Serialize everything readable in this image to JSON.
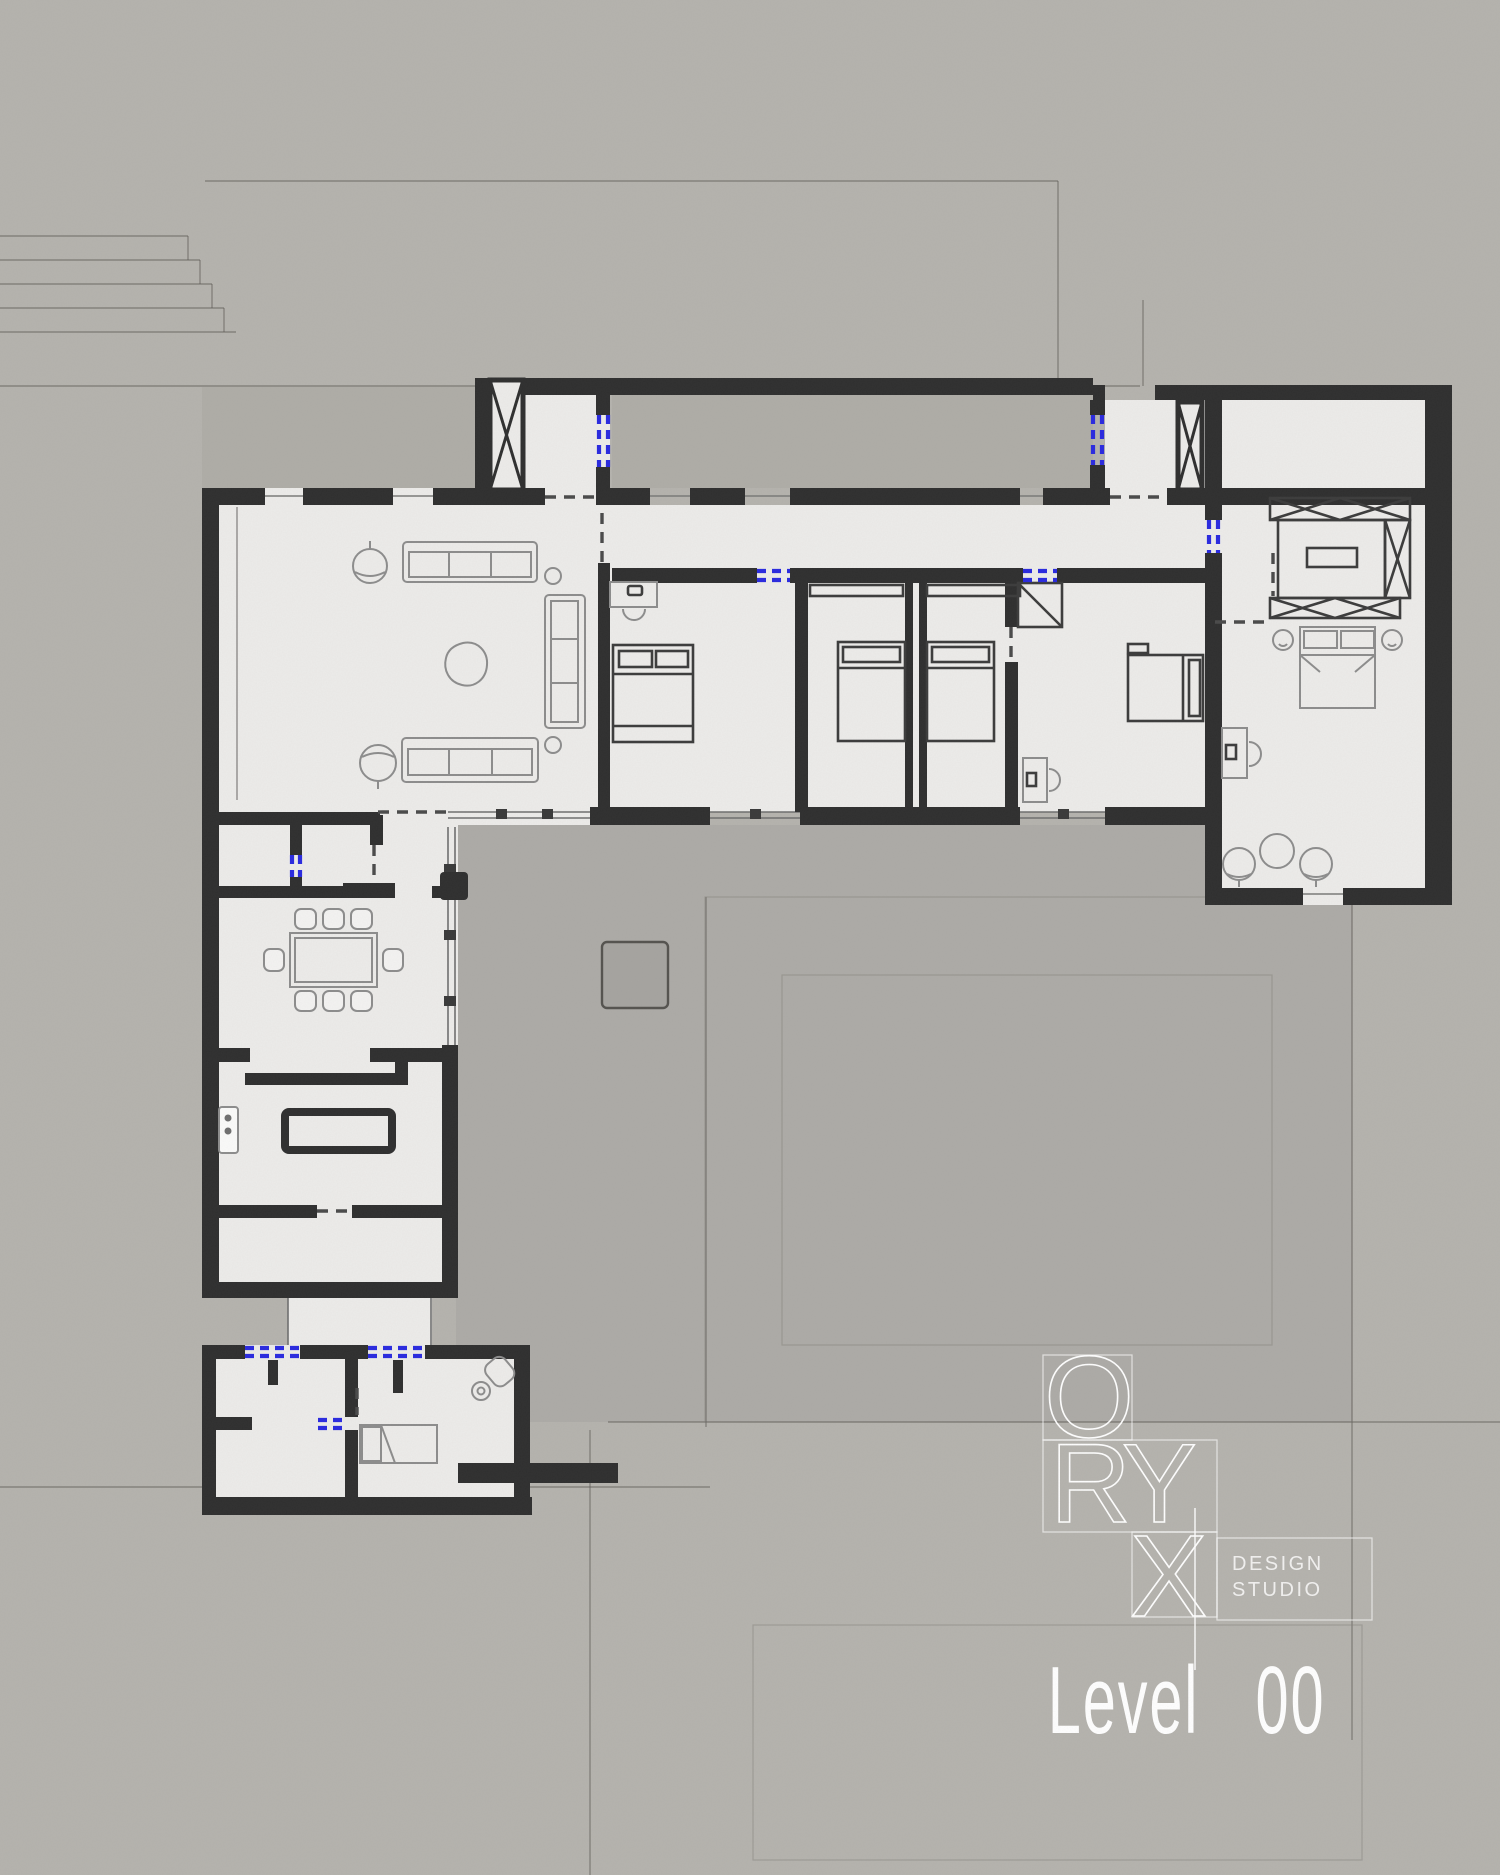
{
  "title": {
    "word": "Level",
    "number": "00"
  },
  "logo": {
    "brand": "ORYX",
    "letters": [
      "O",
      "R",
      "Y",
      "X"
    ],
    "design": "DESIGN",
    "studio": "STUDIO"
  },
  "palette": {
    "background": "#b5b3ae",
    "courtyard": "#aeaca7",
    "floor": "#edecea",
    "wall": "#2f2f2f",
    "door_accent": "#2a2ae0",
    "furniture_line": "#8d8d8d",
    "furniture_dark": "#3c3c3c",
    "text_white": "#ffffff"
  },
  "plan": {
    "type": "architectural-floor-plan",
    "level": "00",
    "rooms": [
      {
        "name": "living-room",
        "furniture": [
          "sofa",
          "sofa",
          "sofa",
          "armchair",
          "armchair",
          "coffee-table",
          "side-table",
          "side-table"
        ]
      },
      {
        "name": "entry-vestibule-west",
        "furniture": [
          "stair-shaft",
          "door"
        ]
      },
      {
        "name": "entry-vestibule-east",
        "furniture": [
          "stair-shaft",
          "door"
        ]
      },
      {
        "name": "corridor",
        "furniture": []
      },
      {
        "name": "bedroom-1",
        "furniture": [
          "double-bed",
          "desk",
          "desk-chair"
        ]
      },
      {
        "name": "bedroom-2",
        "furniture": [
          "bed",
          "closet"
        ]
      },
      {
        "name": "bedroom-3",
        "furniture": [
          "bed",
          "closet"
        ]
      },
      {
        "name": "bedroom-4",
        "furniture": [
          "double-bed",
          "desk",
          "desk-chair",
          "closet",
          "nightstand"
        ]
      },
      {
        "name": "master-suite",
        "furniture": [
          "wardrobe-unit",
          "wardrobe-unit",
          "wardrobe-unit",
          "tv-island",
          "double-bed",
          "nightstand",
          "nightstand",
          "desk",
          "lounge-chair",
          "lounge-chair",
          "round-table"
        ]
      },
      {
        "name": "hallway",
        "furniture": [
          "door"
        ]
      },
      {
        "name": "dining-room",
        "furniture": [
          "dining-table",
          "chair",
          "chair",
          "chair",
          "chair",
          "chair",
          "chair",
          "chair",
          "chair"
        ]
      },
      {
        "name": "kitchen",
        "furniture": [
          "island-counter",
          "counter-row",
          "fridge"
        ]
      },
      {
        "name": "mudroom",
        "furniture": [
          "sliding-door"
        ]
      },
      {
        "name": "annex-room-west",
        "furniture": [
          "door"
        ]
      },
      {
        "name": "annex-bedroom",
        "furniture": [
          "single-bed",
          "toilet",
          "sink",
          "door"
        ]
      },
      {
        "name": "courtyard",
        "furniture": [
          "planter"
        ]
      }
    ],
    "door_count_blue": 9
  }
}
